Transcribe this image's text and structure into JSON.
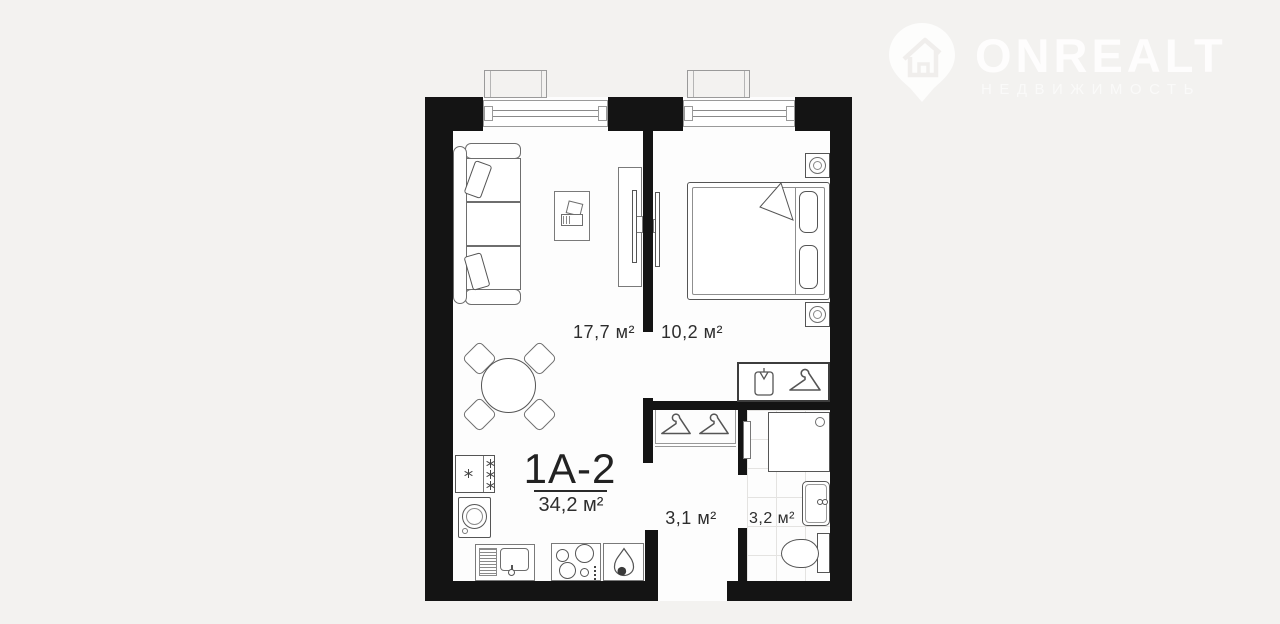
{
  "watermark": {
    "brand": "ONREALT",
    "tagline": "НЕДВИЖИМОСТЬ",
    "icon": "house-location-pin"
  },
  "unit": {
    "label": "1А-2",
    "total_area": "34,2 м²"
  },
  "rooms": {
    "living": {
      "name": "living-room",
      "area": "17,7 м²"
    },
    "bedroom": {
      "name": "bedroom",
      "area": "10,2 м²"
    },
    "hallway": {
      "name": "hallway",
      "area": "3,1 м²"
    },
    "bathroom": {
      "name": "bathroom",
      "area": "3,2 м²"
    }
  },
  "colors": {
    "background": "#f3f2f0",
    "wall": "#141414",
    "floor": "#fdfdfd",
    "furniture_line": "#6e6e6e",
    "label_text": "#2d2d2d",
    "watermark": "#ffffff"
  }
}
